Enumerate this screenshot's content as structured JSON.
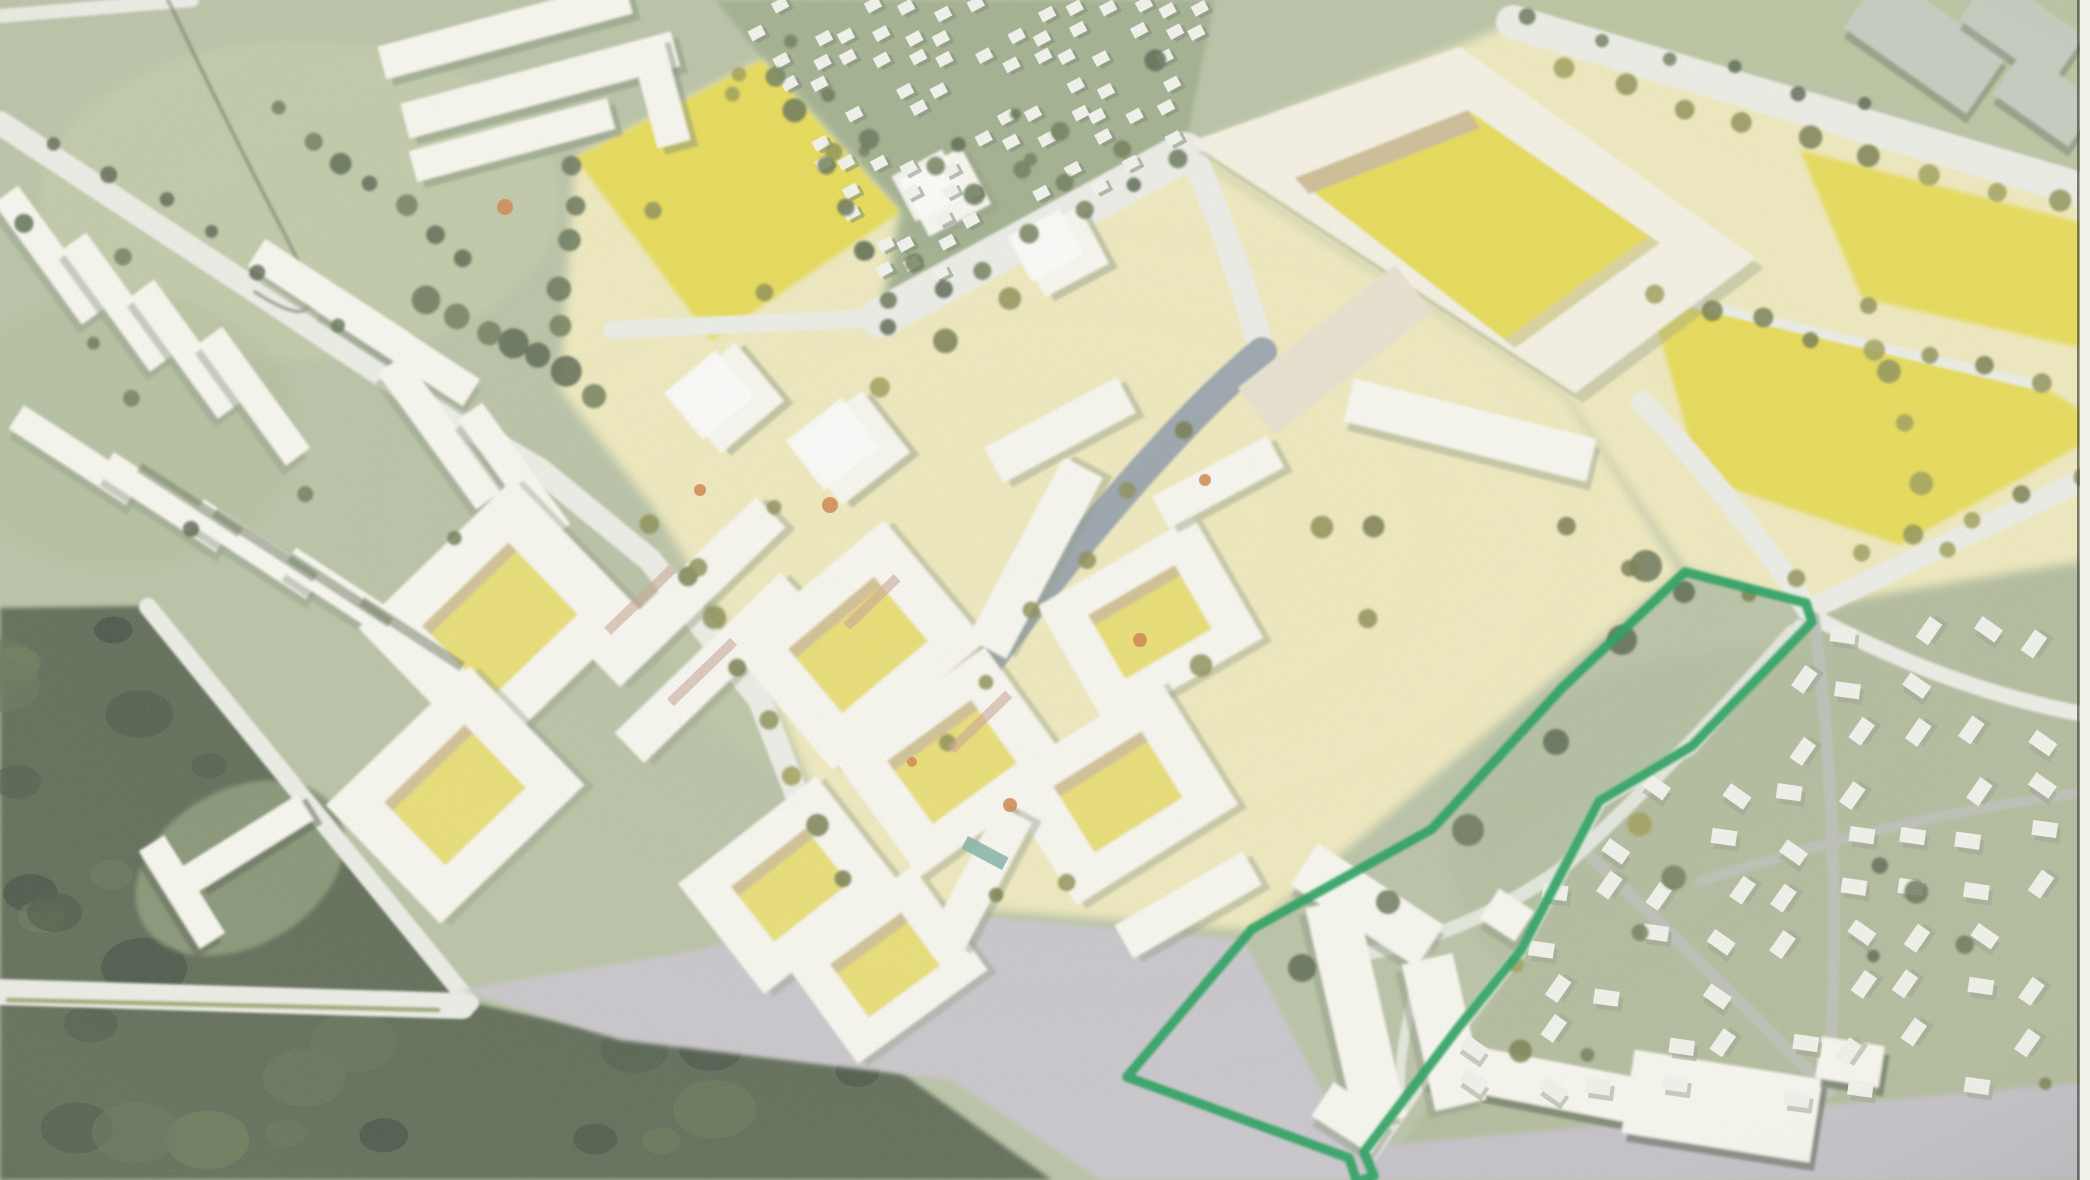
{
  "document": {
    "title": "Aerial masterplan rendering with hand-drawn site boundary",
    "media": "scanned watercolor-style bird's-eye architectural illustration",
    "visible_text": "none"
  },
  "palette": {
    "base": "#b6c1a2",
    "grassLight": "#c6cda9",
    "grassDark": "#9cad89",
    "stripGreen": "#b7c29b",
    "districtGreen": "#aeb998",
    "clearing": "#7f8f6e",
    "forest": "#53624b",
    "forestDeep": "#41503d",
    "paleYellow": "#f1ebbc",
    "brightYellow": "#e8dc4e",
    "courtYellow": "#eadf6e",
    "building": "#fbfaf3",
    "buildingShade": "#8f9980",
    "schoolCream": "#f7f4e6",
    "tan": "#c8b49c",
    "pink": "#c9a193",
    "roadWhite": "#eef0e9",
    "roadGray": "#b9bdb4",
    "roadBlue": "#97a2ab",
    "pathLight": "#e4e8de",
    "plaza": "#c8c5cc",
    "bottomRoad": "#c2bfc8",
    "median": "#9aa86d",
    "treeOlive": "#878a4d",
    "treeOliveDark": "#6f7442",
    "treeGreen": "#5d6b4e",
    "grayBuilding": "#c3cabe",
    "grayBuildingDark": "#717e6d",
    "shadowDark": "#4e5a49",
    "marker": "#149a52",
    "accentOrange": "#cf7f42",
    "accentTeal": "#7fb2a6",
    "scanLine": "#50504a"
  },
  "site_boundary": {
    "label": "hand-drawn green marker outlining reserved site",
    "color": "#149a52",
    "points": "1685,572 1806,603 1812,622 1692,746 1599,801 1521,950 1458,1028 1364,1152 1374,1176 1357,1182 1349,1158 1127,1077 1252,929 1432,829 1562,688"
  },
  "regions": [
    {
      "id": "existing-estate-west",
      "desc": "white housing slabs on green"
    },
    {
      "id": "small-house-neighborhood",
      "desc": "dense small houses with trees, top center"
    },
    {
      "id": "school-courtyard-building",
      "desc": "large ring building with bright yellow courtyard"
    },
    {
      "id": "sports-fields",
      "desc": "bright yellow pitches"
    },
    {
      "id": "new-development",
      "desc": "pale yellow area with white perimeter blocks"
    },
    {
      "id": "forest-southwest",
      "desc": "dark green woodland"
    },
    {
      "id": "detached-house-district-east",
      "desc": "small detached houses on green"
    },
    {
      "id": "marked-site",
      "desc": "green outlined parcel with existing institution building"
    }
  ]
}
